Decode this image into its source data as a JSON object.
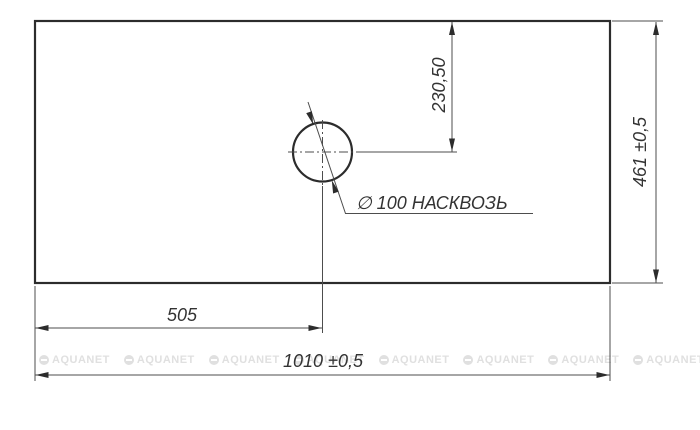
{
  "drawing": {
    "title_hint": "countertop-hole-drilling-drawing",
    "dimensions": {
      "hole_offset_vertical": "230,50",
      "panel_depth": "461 ±0,5",
      "hole_offset_horizontal": "505",
      "panel_width": "1010 ±0,5"
    },
    "hole_callout": "∅ 100 НАСКВОЗЬ",
    "watermark": "AQUANET",
    "colors": {
      "outline": "#2c2c2c",
      "thin_line": "#4d4d4d",
      "text": "#333333",
      "watermark": "#e0e0e0",
      "background": "#ffffff"
    }
  }
}
